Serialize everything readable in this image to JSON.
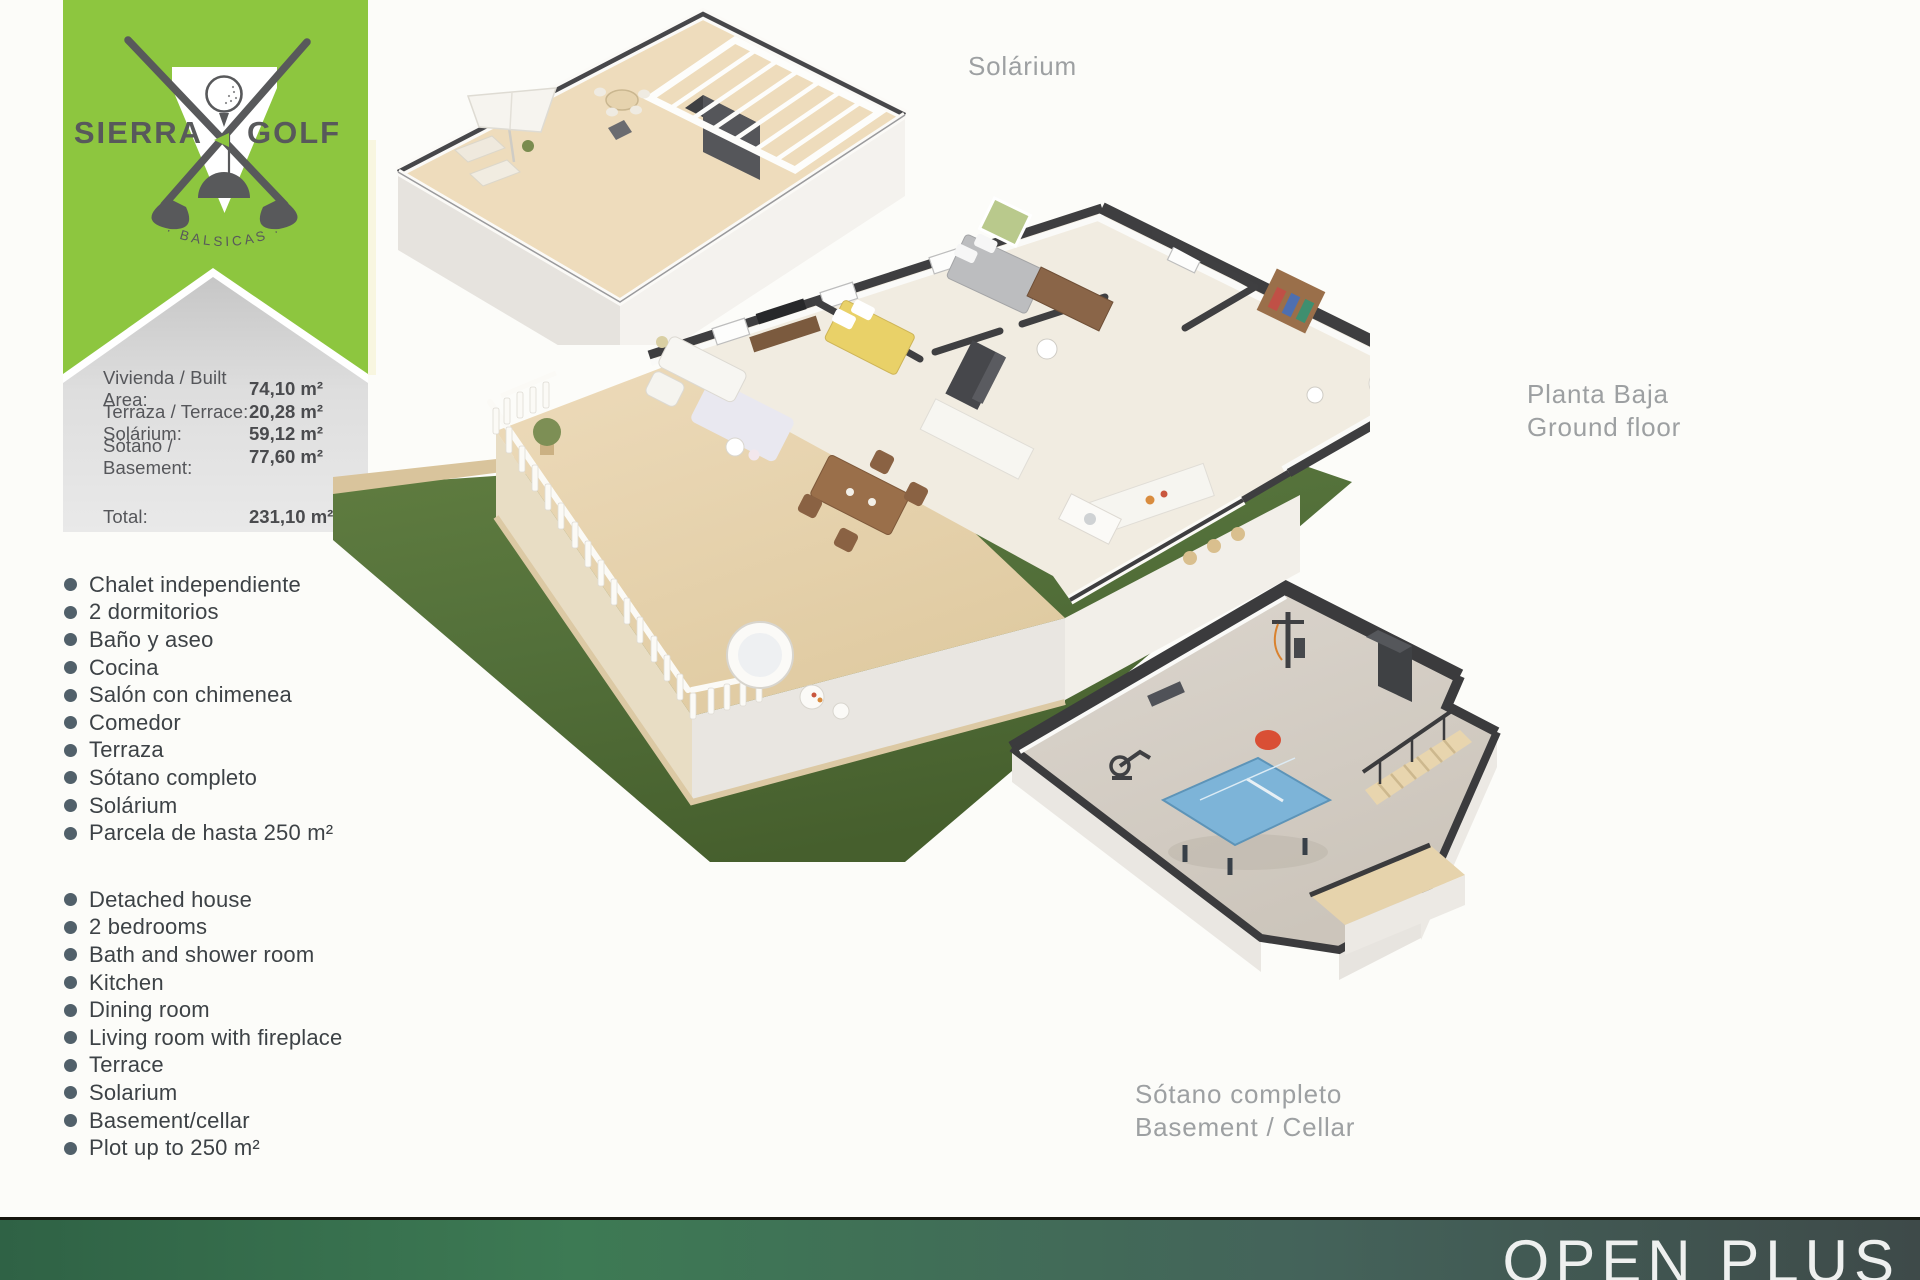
{
  "page": {
    "bg": "#fcfcf9"
  },
  "brand": {
    "name_left": "SIERRA",
    "name_right": "GOLF",
    "subtitle": "· BALSICAS ·",
    "green": "#8dc63f",
    "dark_gray": "#58595b"
  },
  "area_panel": {
    "rows": [
      {
        "label": "Vivienda / Built Area:",
        "value": "74,10 m²"
      },
      {
        "label": "Terraza / Terrace:",
        "value": "20,28 m²"
      },
      {
        "label": "Solárium:",
        "value": "59,12 m²"
      },
      {
        "label": "Sótano / Basement:",
        "value": "77,60 m²"
      }
    ],
    "total_label": "Total:",
    "total_value": "231,10 m²"
  },
  "features_es": [
    "Chalet independiente",
    "2 dormitorios",
    "Baño y aseo",
    "Cocina",
    "Salón con chimenea",
    "Comedor",
    "Terraza",
    "Sótano completo",
    "Solárium",
    "Parcela de hasta 250 m²"
  ],
  "features_en": [
    "Detached house",
    "2 bedrooms",
    "Bath and shower room",
    "Kitchen",
    "Dining room",
    "Living room with fireplace",
    "Terrace",
    "Solarium",
    "Basement/cellar",
    "Plot up to 250 m²"
  ],
  "plan_labels": {
    "solarium": "Solárium",
    "ground_floor_es": "Planta Baja",
    "ground_floor_en": "Ground floor",
    "basement_es": "Sótano completo",
    "basement_en": "Basement / Cellar"
  },
  "footer": {
    "title": "OPEN PLUS",
    "gradient_start": "#2f6245",
    "gradient_end": "#3e4a49"
  },
  "palette": {
    "grass_green": "#55713a",
    "terrace_beige": "#e8d6b4",
    "wall_cap_dark": "#3b3b3d",
    "pingpong_blue": "#7db4d8"
  }
}
